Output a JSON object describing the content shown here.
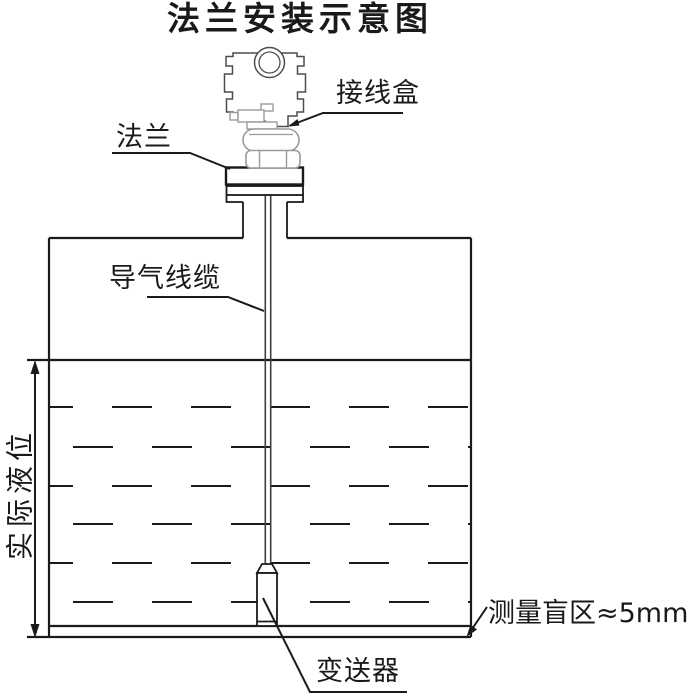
{
  "title": "法兰安装示意图",
  "labels": {
    "junction_box": "接线盒",
    "flange": "法兰",
    "air_cable": "导气线缆",
    "actual_level": "实际液位",
    "blind_zone": "测量盲区≈5mm",
    "transmitter": "变送器"
  },
  "colors": {
    "ink": "#1a1a1a",
    "device_line": "#4d4d4d",
    "device_light": "#9b9b9b",
    "background": "#ffffff"
  }
}
